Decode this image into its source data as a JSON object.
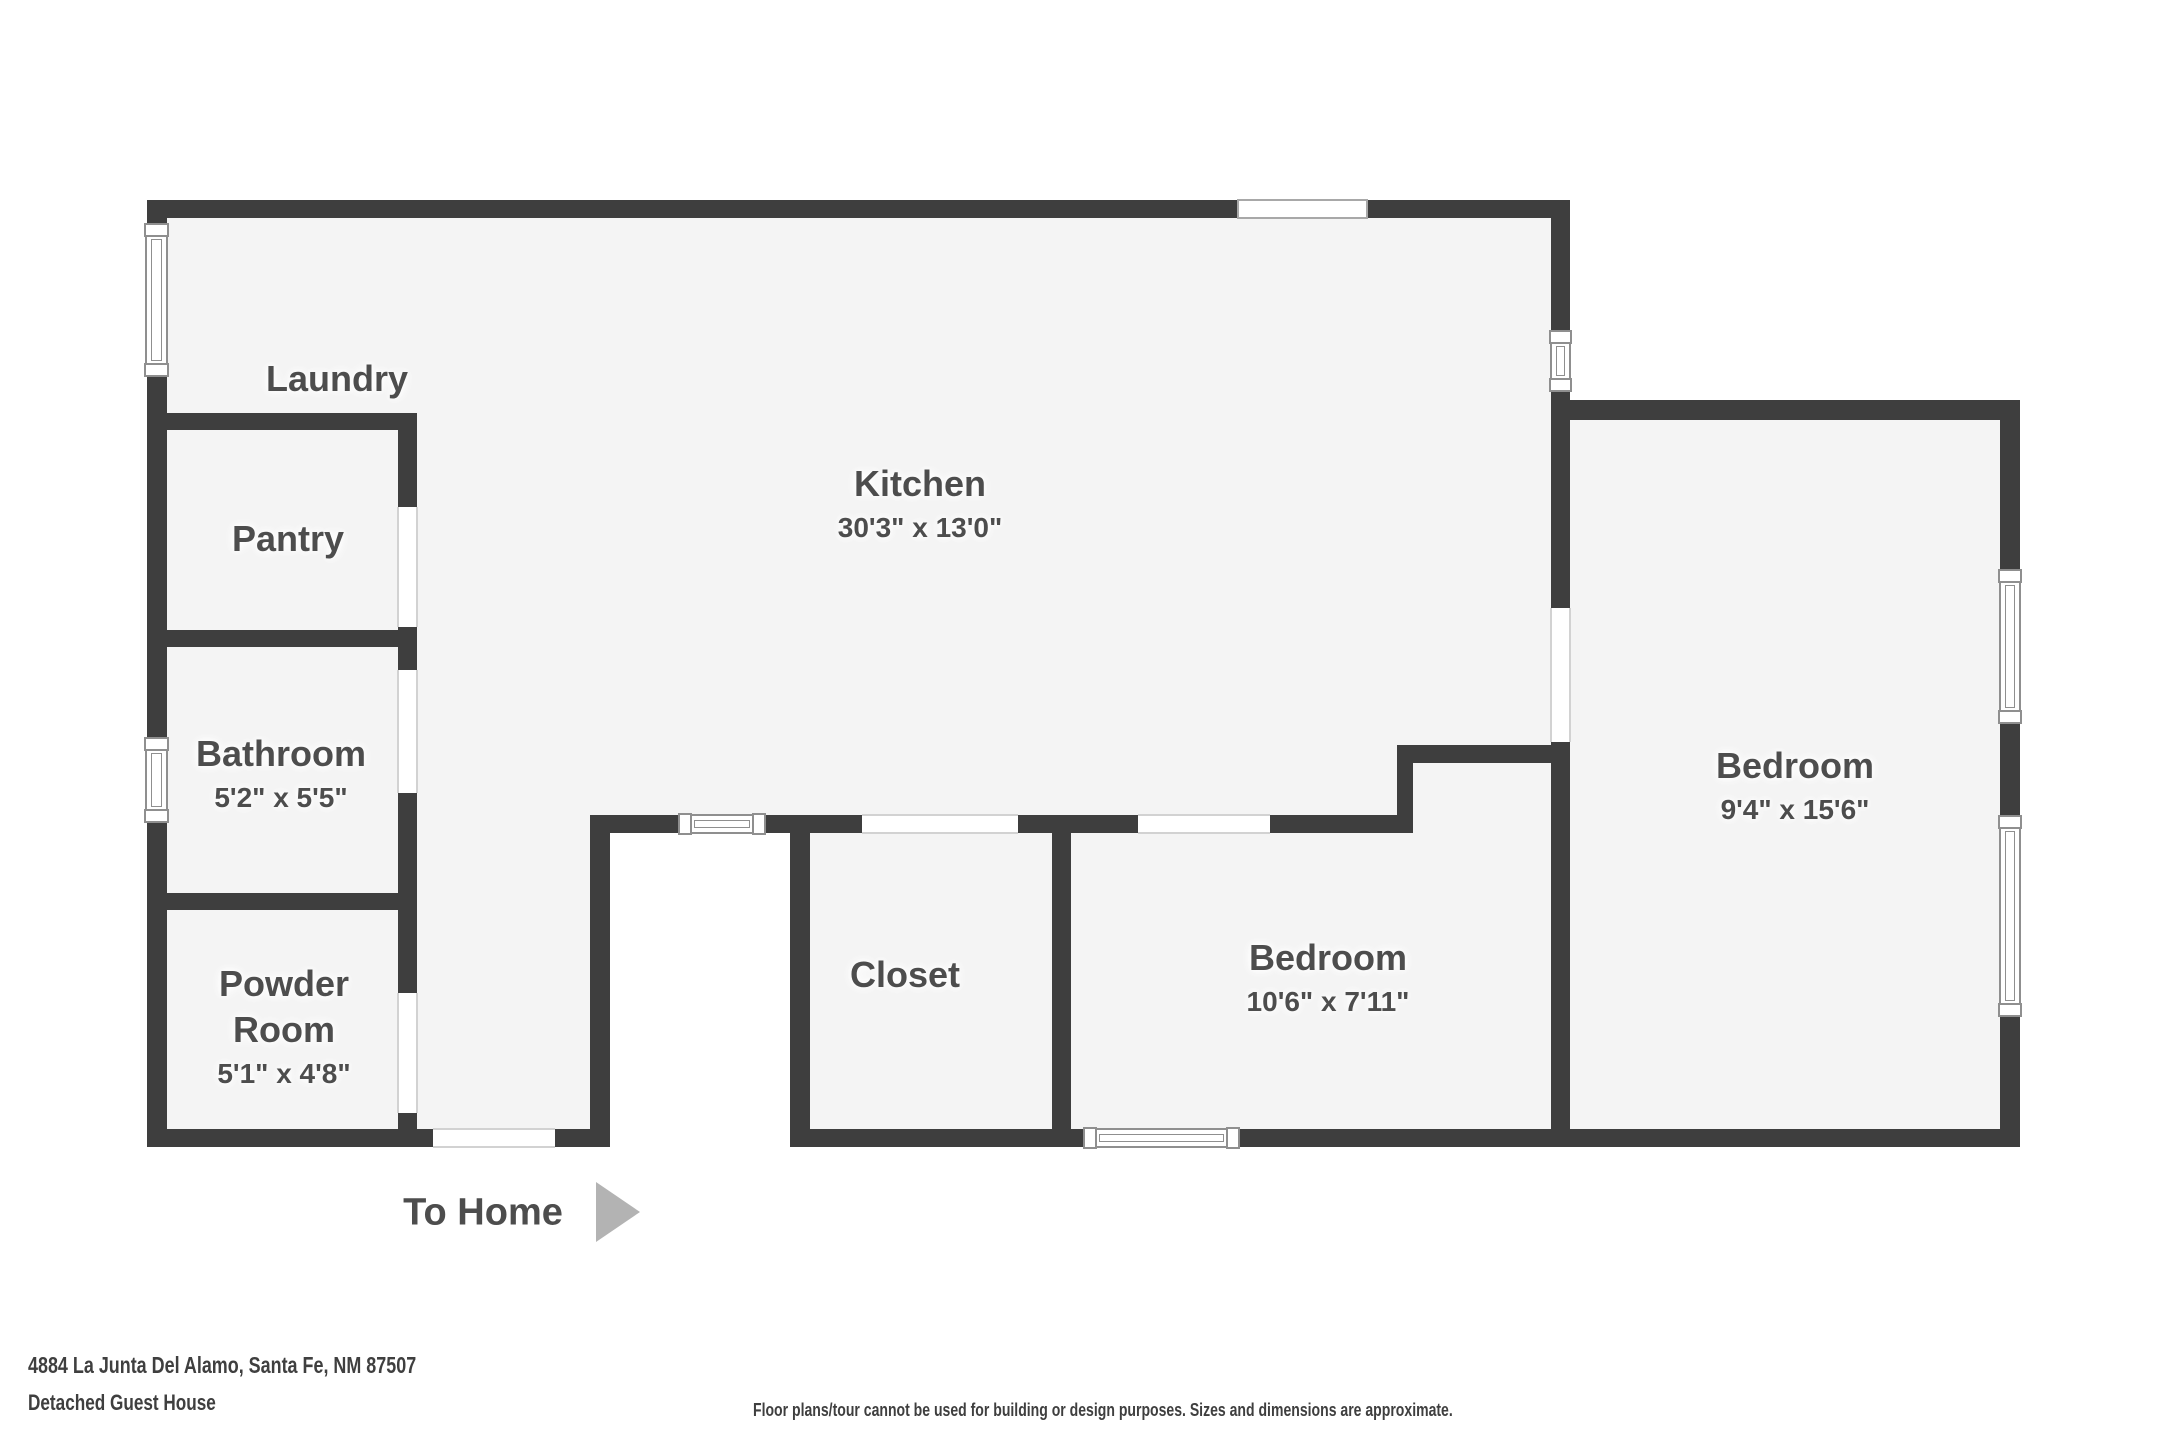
{
  "plan": {
    "rooms": [
      {
        "id": "laundry",
        "name": "Laundry",
        "dims": ""
      },
      {
        "id": "pantry",
        "name": "Pantry",
        "dims": ""
      },
      {
        "id": "bathroom",
        "name": "Bathroom",
        "dims": "5'2\" x 5'5\""
      },
      {
        "id": "powder",
        "name": "Powder Room",
        "dims": "5'1\" x 4'8\""
      },
      {
        "id": "kitchen",
        "name": "Kitchen",
        "dims": "30'3\" x 13'0\""
      },
      {
        "id": "closet",
        "name": "Closet",
        "dims": ""
      },
      {
        "id": "bedroom1",
        "name": "Bedroom",
        "dims": "10'6\" x 7'11\""
      },
      {
        "id": "bedroom2",
        "name": "Bedroom",
        "dims": "9'4\" x 15'6\""
      }
    ],
    "exit_label": "To Home"
  },
  "footer": {
    "address": "4884 La Junta Del Alamo, Santa Fe, NM 87507",
    "subtitle": "Detached Guest House",
    "disclaimer": "Floor plans/tour cannot be used for building or design purposes. Sizes and dimensions are approximate."
  },
  "colors": {
    "wall": "#3e3e3e",
    "floor": "#f4f4f4",
    "outside": "#ffffff",
    "label_text": "#4d4d4d",
    "footer_text": "#3f3f3f",
    "arrow": "#b3b3b3",
    "window_border": "#8f8f8f"
  }
}
